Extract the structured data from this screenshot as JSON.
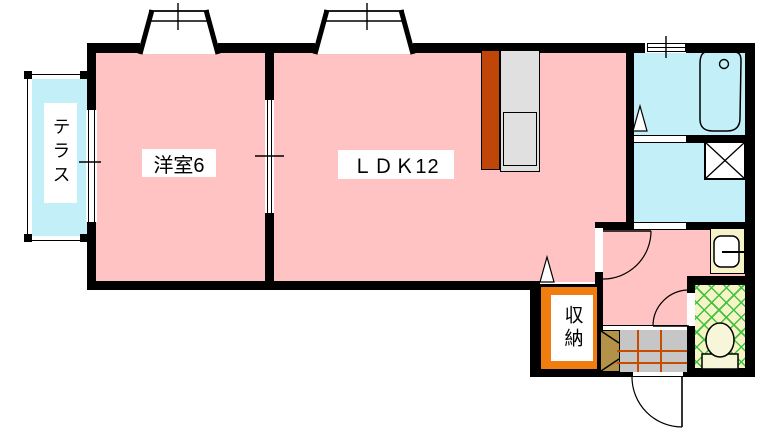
{
  "floorplan": {
    "rooms": {
      "terrace": "テラス",
      "western_room": "洋室6",
      "ldk": "ＬＤＫ12",
      "storage": "収納"
    },
    "colors": {
      "room_pink": "#ffc3c3",
      "water_cyan": "#c3f0f8",
      "storage_orange": "#f07d10",
      "counter_rust": "#c04508",
      "counter_gray": "#e0e0e0",
      "entrance_tile_gray": "#c6c6c6",
      "entrance_grid_orange": "#c84b00",
      "toilet_pale_yellow": "#f6f3c6",
      "lattice_green": "#3dc43d",
      "cabinet_tan": "#b29148",
      "wall_black": "#000000"
    }
  }
}
